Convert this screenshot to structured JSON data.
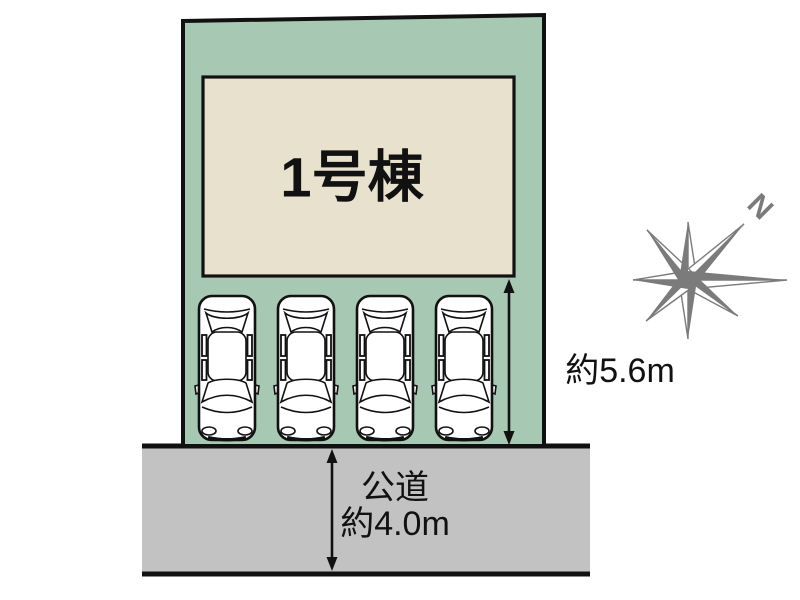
{
  "colors": {
    "plot_green": "#a7c8b2",
    "building_beige": "#e8e1ce",
    "road_gray": "#c2c2c2",
    "line_black": "#111111",
    "compass_gray": "#7b7b7b",
    "car_white": "#ffffff"
  },
  "site_plan": {
    "building": {
      "label": "1号棟"
    },
    "parking": {
      "car_count": 4,
      "depth_label": "約5.6m"
    },
    "road": {
      "name_label": "公道",
      "width_label": "約4.0m"
    },
    "compass": {
      "north_label": "N"
    }
  }
}
